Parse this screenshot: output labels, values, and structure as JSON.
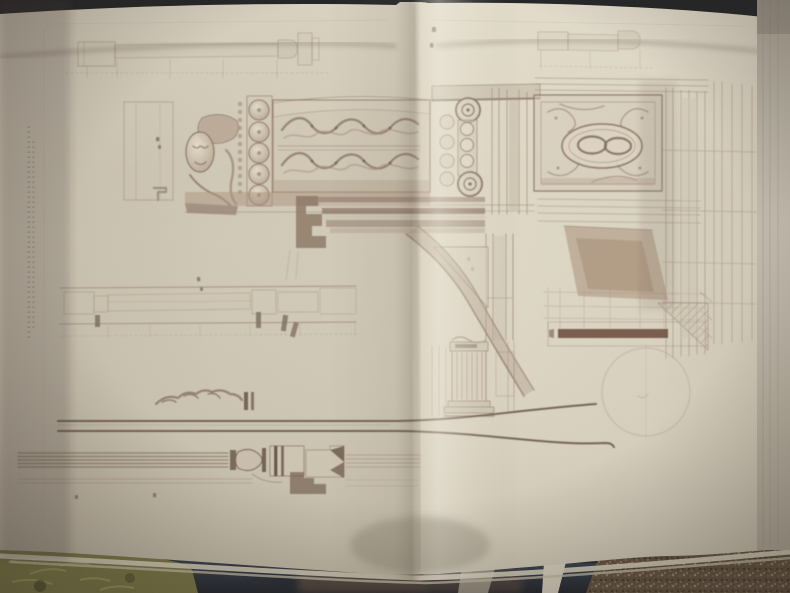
{
  "scene": {
    "aria_label": "Photograph of an open folio book showing a sepia engraved plate of classical architectural details: carved acanthus frieze, corbel mask, scroll consoles, oval medallion panel with interlaced rings, arch springing with entablature, handrail and baluster profiles",
    "legible_text": "none (engraved captions too small / out of focus to read)"
  },
  "palette": {
    "page_cream": "#d5cebd",
    "page_highlight": "#eae4d5",
    "page_shadow": "#b9b1a0",
    "engraving_sepia": "#8a7262",
    "engraving_dark": "#5f4c40",
    "engraving_wash": "#c9bfae",
    "section_bar_brown": "#6a4c3e",
    "background_navy": "#2a3545",
    "background_carpet": "#584838",
    "background_green": "#72703f",
    "page_edge_gray": "#b5afa3"
  },
  "plate": {
    "figure_regions": [
      "top-left-molding-profile",
      "top-right-molding-profile",
      "plan-outline-rectangle",
      "corbel-mask-carving",
      "disc-rosette-band",
      "carved-acanthus-frieze",
      "scroll-console-with-discs",
      "oval-medallion-panel-interlaced-rings",
      "right-pilaster-molding-strips",
      "entablature-bands-and-arch-springing",
      "spandrel-panel",
      "long-handrail-profile",
      "construction-grid-and-section-bar",
      "faint-plan-circle",
      "hatched-stair-section",
      "shadowed-niche-trapezoid",
      "fluted-pilaster-detail",
      "acanthus-fragment",
      "handrail-sweep-curves",
      "baluster-turning-profiles",
      "margin-caption-vertical-illegible"
    ]
  }
}
